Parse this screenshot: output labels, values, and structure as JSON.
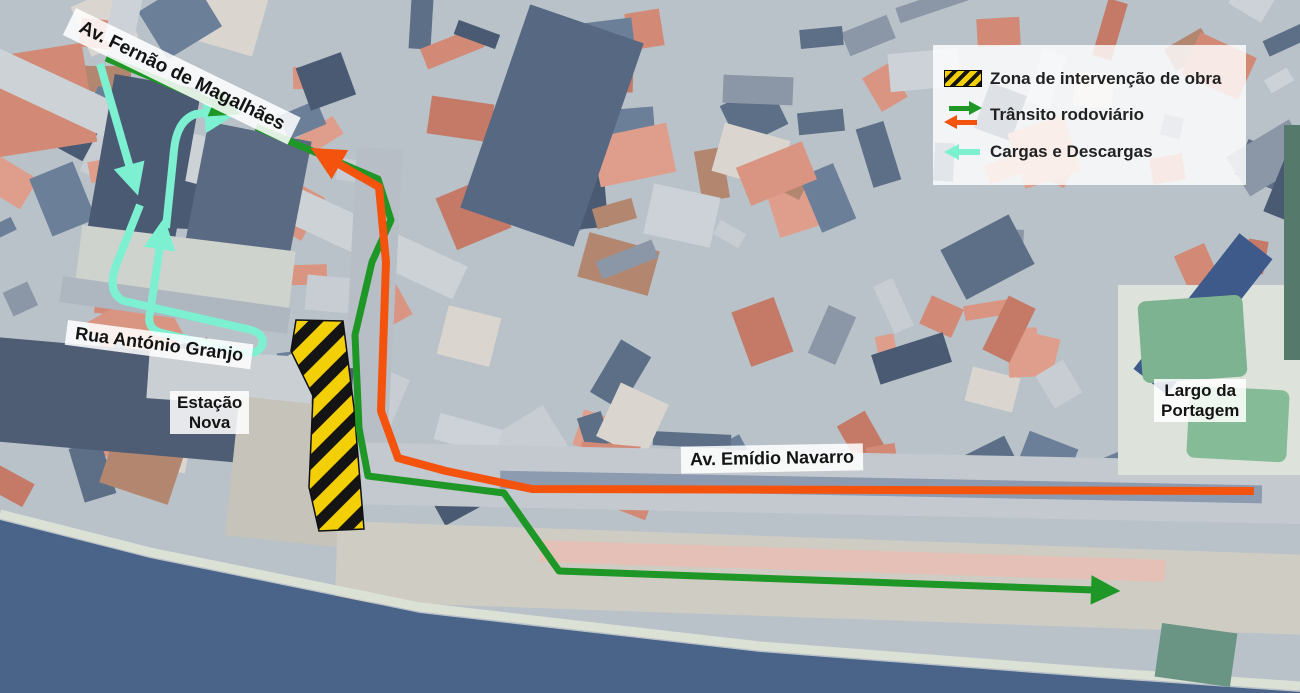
{
  "colors": {
    "green": "#1f9727",
    "orange": "#f4530e",
    "cyan": "#7df0d2",
    "hatch_yellow": "#f2cf06",
    "hatch_black": "#141414",
    "water": "#4a6389"
  },
  "legend": {
    "items": [
      {
        "id": "construction-zone",
        "label": "Zona de intervenção de obra"
      },
      {
        "id": "road-traffic",
        "label": "Trânsito rodoviário"
      },
      {
        "id": "loading-unloading",
        "label": "Cargas e Descargas"
      }
    ]
  },
  "map_labels": {
    "av_fernao": {
      "text": "Av. Fernão de Magalhães"
    },
    "rua_granjo": {
      "text": "Rua António Granjo"
    },
    "estacao": {
      "lines": [
        "Estação",
        "Nova"
      ]
    },
    "av_emidio": {
      "text": "Av. Emídio Navarro"
    },
    "largo": {
      "lines": [
        "Largo da",
        "Portagem"
      ]
    }
  },
  "construction_zone": {
    "points": "296,320 343,321 354,408 364,529 319,531 309,487 313,396 291,351"
  },
  "routes": {
    "green": {
      "legend_ref": "Trânsito rodoviário",
      "seg1": "M 106,58 L 216,104",
      "seg2": "M 256,127 L 378,179 L 391,220 L 372,262 L 355,335 L 359,428 L 368,476 L 504,493 L 559,571 L 1094,590"
    },
    "orange": {
      "legend_ref": "Trânsito rodoviário",
      "seg1": "M 1254,491 L 532,489 L 446,471 L 398,458 L 381,411 L 386,262 L 379,187 L 337,163"
    },
    "cyan": {
      "legend_ref": "Cargas e Descargas",
      "seg1": "M 100,64 L 130,168",
      "seg2": "M 140,205 L 119,258 Q 104,292 124,301 L 247,329 Q 266,333 262,346 Q 256,356 240,352 L 162,333 Q 146,329 150,313 L 160,246",
      "seg3": "M 166,228 L 174,150 Q 177,120 196,114 L 206,113"
    }
  }
}
